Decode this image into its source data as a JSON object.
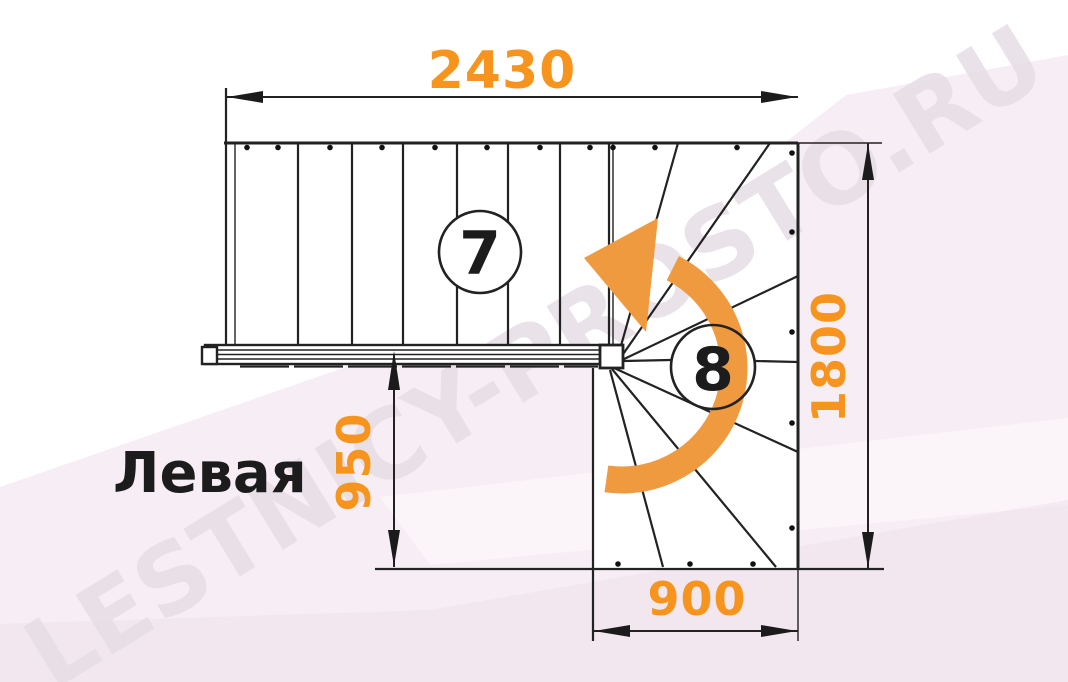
{
  "page": {
    "label": "Левая",
    "watermark": "LESTNICY-PROSTO.RU"
  },
  "dimensions": {
    "top_width": "2430",
    "right_height": "1800",
    "left_offset": "950",
    "bottom_width": "900"
  },
  "markers": {
    "straight_flight": "7",
    "winder_flight": "8"
  },
  "colors": {
    "dimension_text": "#f7941e",
    "turn_arrow": "#f09a40",
    "drawing_line": "#222222",
    "background_pink": "#f7edf4",
    "watermark": "#e6dde5"
  },
  "diagram": {
    "type": "staircase-plan",
    "orientation": "left-turn",
    "straight_tread_count": 7,
    "winder_tread_count": 8,
    "top_width_mm": 2430,
    "right_height_mm": 1800,
    "left_offset_mm": 950,
    "bottom_width_mm": 900
  }
}
